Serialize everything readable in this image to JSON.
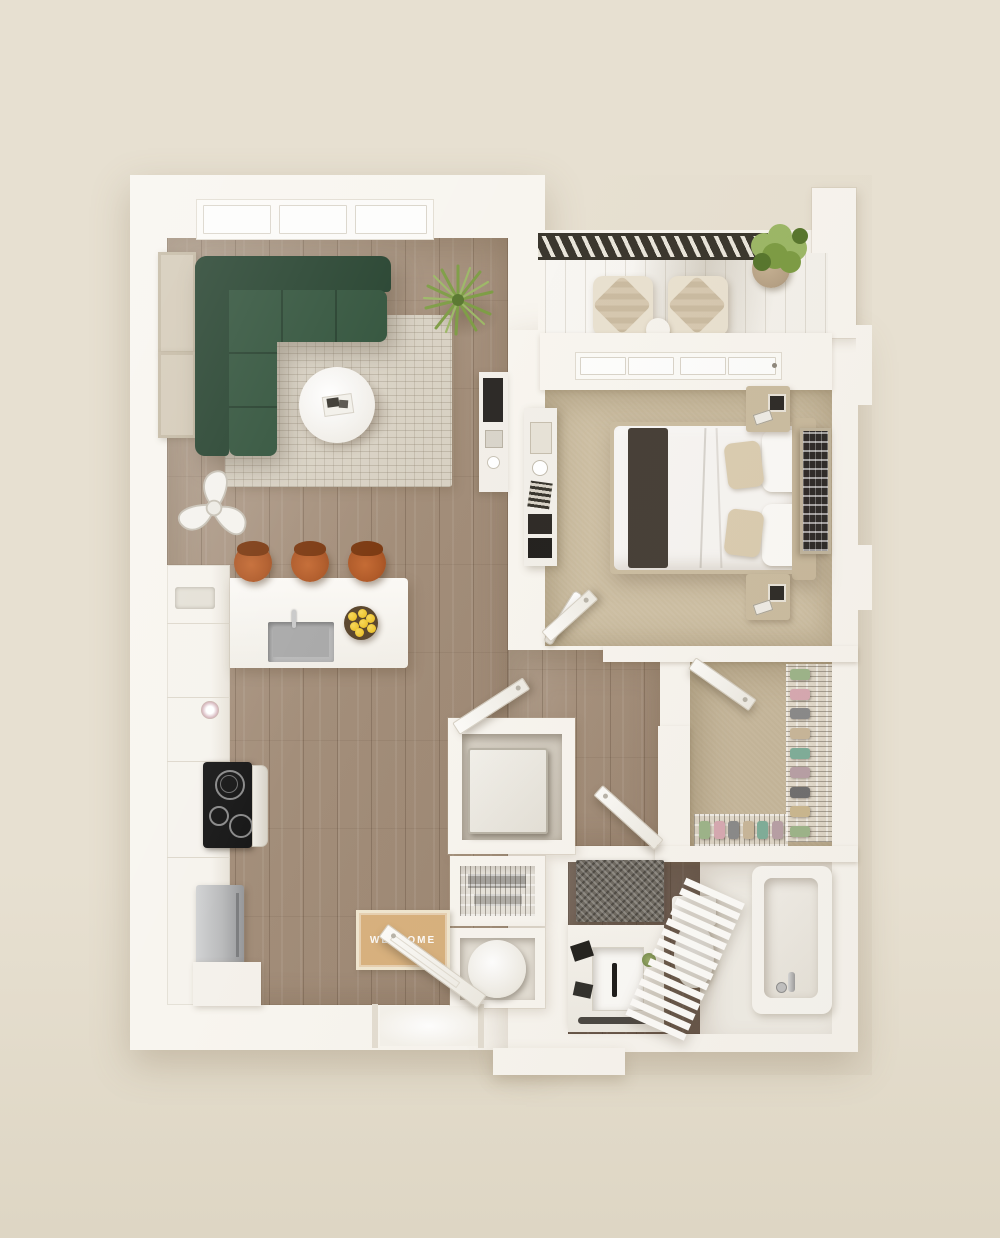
{
  "scene": {
    "type": "3d-apartment-floor-plan-top-down",
    "width": 1000,
    "height": 1238
  },
  "entry": {
    "mat_text": "WELCOME",
    "furniture": [
      "welcome-mat",
      "entry-door-open",
      "entry-stoop"
    ]
  },
  "living_room": {
    "windows": 3,
    "furniture": [
      "green-l-shaped-sectional-sofa",
      "area-rug",
      "round-coffee-table",
      "wall-art-frame",
      "wall-art-frame",
      "potted-plant",
      "ceiling-fan",
      "media-console"
    ]
  },
  "kitchen": {
    "bar_stools": 3,
    "furniture": [
      "counter-peninsula",
      "sink",
      "lemon-bowl",
      "induction-cooktop",
      "oven",
      "refrigerator",
      "open-shelving",
      "flower-vase",
      "base-cabinets"
    ]
  },
  "balcony": {
    "furniture": [
      "lounge-chair",
      "lounge-chair",
      "side-table",
      "potted-plant"
    ],
    "railing": "dark-slatted-railing"
  },
  "bedroom": {
    "pillows": 4,
    "furniture": [
      "double-bed",
      "dark-throw-blanket",
      "headboard",
      "nightstand",
      "nightstand",
      "dresser-console",
      "wall-art-frame",
      "sliding-balcony-door",
      "floor-lamp"
    ]
  },
  "walk_in_closet": {
    "furniture": [
      "wire-shoe-rack-right",
      "wire-shoe-rack-bottom",
      "closet-door-open"
    ],
    "shoe_colors": [
      "#9db58a",
      "#d7a9b2",
      "#8a8a8a",
      "#c9b79a",
      "#7fae9a",
      "#b8a0a6",
      "#6f6f6f",
      "#cbb890"
    ]
  },
  "bathroom": {
    "furniture": [
      "vanity-sink",
      "black-faucet",
      "toilet",
      "bathtub",
      "towel-ladder",
      "speckled-bath-rug"
    ]
  },
  "laundry_closet": {
    "furniture": [
      "washer-dryer-unit"
    ]
  },
  "utility_closets": {
    "furniture": [
      "wire-pantry-shelves",
      "water-heater-cylinder"
    ]
  },
  "doors": {
    "open_doors": 5
  },
  "colors": {
    "background": "#e7e0d1",
    "background_lower": "#ded6c4",
    "wall": "#f8f5ef",
    "wall_shade": "#eae5dc",
    "wood": "#a5907c",
    "wood_bath": "#8b7364",
    "carpet_bedroom": "#cdbfa3",
    "carpet_closet": "#c5b69a",
    "deck": "#f0ece4",
    "railing": "#3b372e",
    "sofa": "#2e5038",
    "sofa_dark": "#223f2b",
    "sofa_seam": "#1d3624",
    "rug": "#d8d1c3",
    "stool": "#b05a28",
    "stool_back": "#7c3a12",
    "lemon": "#edc32e",
    "bowl": "#5c482f",
    "plant": "#7d9c44",
    "plant_dark": "#58762e",
    "plant_light": "#9cb766",
    "steel": "#b9babb",
    "cooktop": "#181818",
    "mat": "#d8b17e",
    "bath_rug": "#6f6a62",
    "art": "#2e2b28",
    "frame_tan": "#d3c9b6",
    "headboard": "#c8b99d",
    "nightstand": "#cbbda1",
    "throw": "#474038",
    "pillow": "#dbcdb1",
    "duvet": "#f7f5f2",
    "chair": "#e9e1d0",
    "chair_cushion": "#d6c8b0",
    "pot": "#b5a084"
  }
}
